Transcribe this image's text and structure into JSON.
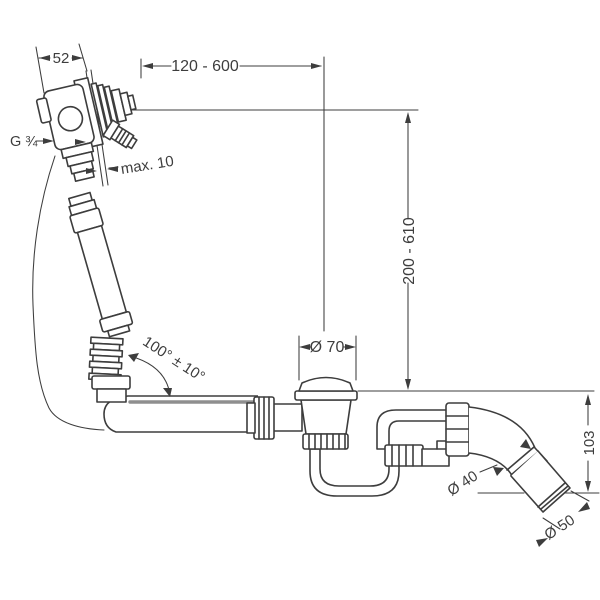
{
  "diagram": {
    "background": "#ffffff",
    "line_color": "#3d3d3d",
    "cable_color": "#8f8f8f",
    "labels": {
      "fitting_depth": "52",
      "length_range": "120 - 600",
      "thread": "G ¾",
      "wall_thickness_max": "max. 10",
      "hose_angle": "100° ± 10°",
      "height_range": "200 - 610",
      "waste_diameter": "Ø 70",
      "outlet_height": "103",
      "pipe_diameter": "Ø 40",
      "outlet_diameter": "Ø 50"
    }
  }
}
